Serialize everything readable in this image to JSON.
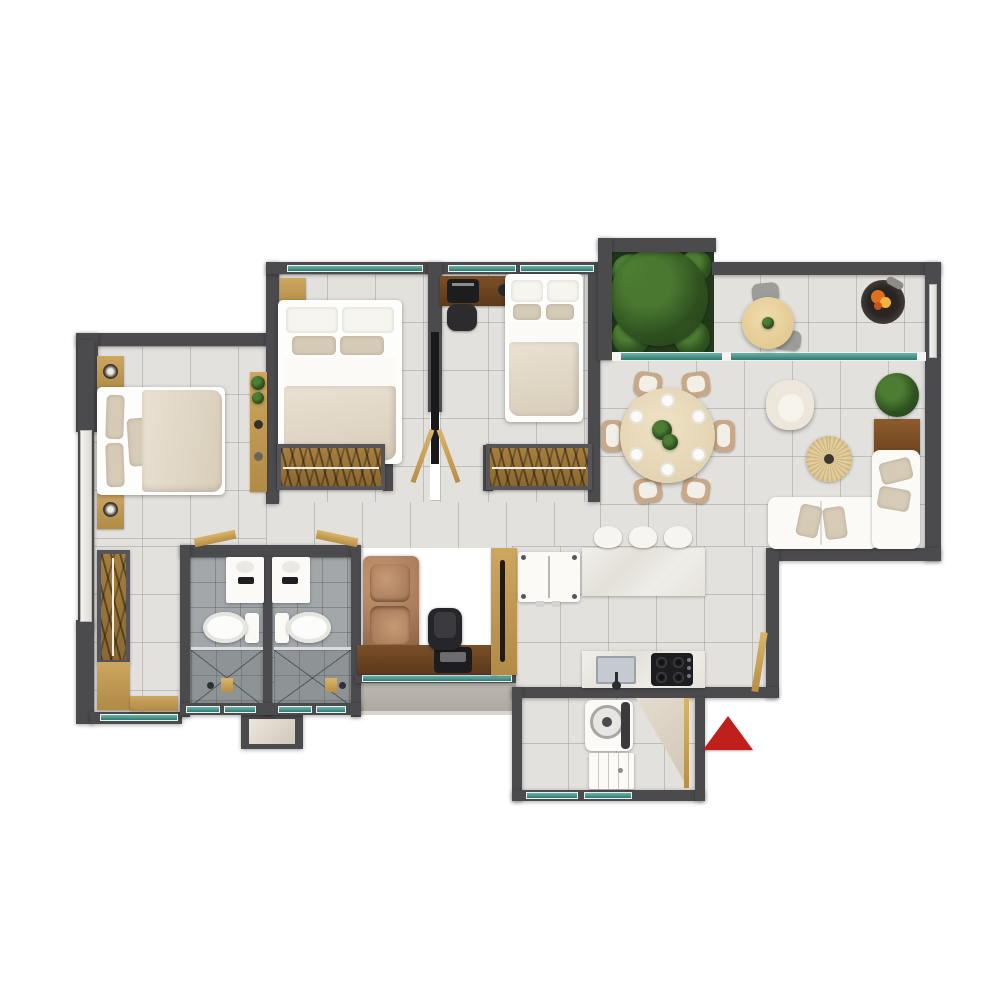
{
  "meta": {
    "description": "Top-down 3D rendered apartment floor plan with two bathrooms, three bed/study zones, open kitchen-dining-living area, planted terrace and utility balcony",
    "canvas": {
      "width": 1000,
      "height": 1000
    }
  },
  "colors": {
    "background": "#ffffff",
    "wall": "#4b4a4d",
    "wall_light": "#6e6e70",
    "floor": "#e3e1dd",
    "grout": "rgba(165,162,157,0.55)",
    "bath_tile": "#a3a7aa",
    "shower_tile": "#8e9396",
    "wood": "#cda65f",
    "wood_dark": "#b08b46",
    "glass": "#2e7a72",
    "glass_hi": "#6fb3a9",
    "white_furniture": "#fbfaf7",
    "bedding_beige": "#e9e1d2",
    "pillow_beige": "#d6cbb6",
    "leather": "#a87c5c",
    "chair_tan": "#c7a98a",
    "rug_jute": "#e2cd9c",
    "marble": "#efede8",
    "concrete": "#b5b1aa",
    "garden_base": "#233a1a",
    "plant_green": "#4d7c33",
    "plant_dark": "#2f5220",
    "appliance_dark": "#1d1d1f",
    "fire_orange": "#e0701f",
    "fire_yellow": "#f4b13e",
    "arrow_red": "#c0201c"
  },
  "legend": {
    "entrance_marker": {
      "shape": "triangle",
      "pointing": "up",
      "color": "#c0201c"
    },
    "rooms": [
      "master-bedroom",
      "bedroom-2",
      "bedroom-3",
      "bathroom-1",
      "bathroom-2",
      "study-nook",
      "kitchen",
      "dining-area",
      "living-area",
      "terrace",
      "garden-patch",
      "utility-balcony",
      "wardrobe-alcove",
      "corridor"
    ],
    "furniture": {
      "master_bedroom": [
        "double-bed",
        "nightstand-with-lamp",
        "nightstand-with-lamp",
        "decor-shelf-with-plants",
        "l-shaped-wardrobe"
      ],
      "bedroom_2": [
        "double-bed",
        "nightstand",
        "open-wardrobe",
        "sliding-door"
      ],
      "bedroom_3": [
        "double-bed",
        "computer-desk",
        "desk-chair",
        "open-wardrobe"
      ],
      "bathrooms": [
        "vanity-sink",
        "toilet",
        "walk-in-shower",
        "window"
      ],
      "study_nook": [
        "leather-loveseat",
        "work-desk-with-computer",
        "office-chair",
        "tall-cabinet"
      ],
      "kitchen": [
        "breakfast-island",
        "bar-stool",
        "bar-stool",
        "bar-stool",
        "refrigerator",
        "sink-counter",
        "gas-hob",
        "entry-door"
      ],
      "dining_area": [
        "round-table-6-settings",
        "dining-chairs-x6"
      ],
      "living_area": [
        "l-shaped-sofa",
        "throw-cushions",
        "armchair",
        "round-jute-rug",
        "side-console",
        "potted-plant"
      ],
      "terrace": [
        "round-coffee-table",
        "outdoor-chairs-x2",
        "fire-pit",
        "sliding-glass-door"
      ],
      "utility_balcony": [
        "washing-machine",
        "base-cabinet",
        "door-swing"
      ]
    }
  }
}
